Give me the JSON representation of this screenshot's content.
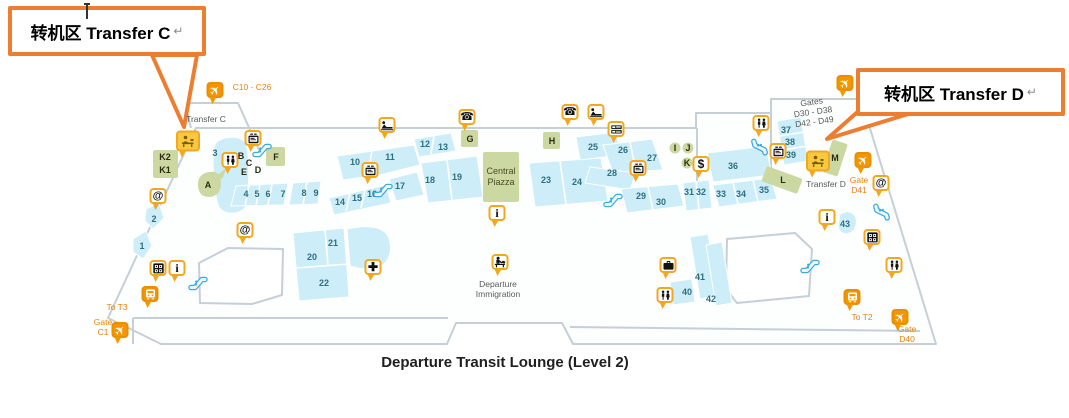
{
  "title": "Departure Transit Lounge (Level 2)",
  "callouts": [
    {
      "label": "转机区 Transfer C",
      "mark": "↵"
    },
    {
      "label": "转机区 Transfer D",
      "mark": "↵"
    }
  ],
  "colors": {
    "callout_orange": "#ED7D31",
    "pin_border_amber": "#F2A71E",
    "pin_orange": "#F49600",
    "retail_blue": "#CDEEF8",
    "zone_green": "#CBD8A2",
    "wall_gray": "#C5CFD7",
    "number_teal": "#2F6F80",
    "gate_text_orange": "#E8820C",
    "escalator_blue": "#3FA9DC"
  },
  "map": {
    "numbers": [
      {
        "n": "1",
        "x": 142,
        "y": 246
      },
      {
        "n": "2",
        "x": 154,
        "y": 219
      },
      {
        "n": "3",
        "x": 215,
        "y": 153
      },
      {
        "n": "4",
        "x": 246,
        "y": 194
      },
      {
        "n": "5",
        "x": 257,
        "y": 194
      },
      {
        "n": "6",
        "x": 268,
        "y": 194
      },
      {
        "n": "7",
        "x": 283,
        "y": 194
      },
      {
        "n": "8",
        "x": 304,
        "y": 193
      },
      {
        "n": "9",
        "x": 316,
        "y": 193
      },
      {
        "n": "10",
        "x": 355,
        "y": 162
      },
      {
        "n": "11",
        "x": 390,
        "y": 157
      },
      {
        "n": "12",
        "x": 425,
        "y": 144
      },
      {
        "n": "13",
        "x": 443,
        "y": 147
      },
      {
        "n": "14",
        "x": 340,
        "y": 202
      },
      {
        "n": "15",
        "x": 357,
        "y": 198
      },
      {
        "n": "16",
        "x": 372,
        "y": 194
      },
      {
        "n": "17",
        "x": 400,
        "y": 186
      },
      {
        "n": "18",
        "x": 430,
        "y": 180
      },
      {
        "n": "19",
        "x": 457,
        "y": 177
      },
      {
        "n": "20",
        "x": 312,
        "y": 257
      },
      {
        "n": "21",
        "x": 333,
        "y": 243
      },
      {
        "n": "22",
        "x": 324,
        "y": 283
      },
      {
        "n": "23",
        "x": 546,
        "y": 180
      },
      {
        "n": "24",
        "x": 577,
        "y": 182
      },
      {
        "n": "25",
        "x": 593,
        "y": 147
      },
      {
        "n": "26",
        "x": 623,
        "y": 150
      },
      {
        "n": "27",
        "x": 652,
        "y": 158
      },
      {
        "n": "28",
        "x": 612,
        "y": 173
      },
      {
        "n": "29",
        "x": 641,
        "y": 196
      },
      {
        "n": "30",
        "x": 661,
        "y": 202
      },
      {
        "n": "31",
        "x": 689,
        "y": 192
      },
      {
        "n": "32",
        "x": 701,
        "y": 192
      },
      {
        "n": "33",
        "x": 721,
        "y": 194
      },
      {
        "n": "34",
        "x": 741,
        "y": 194
      },
      {
        "n": "35",
        "x": 764,
        "y": 190
      },
      {
        "n": "36",
        "x": 733,
        "y": 166
      },
      {
        "n": "37",
        "x": 786,
        "y": 130
      },
      {
        "n": "38",
        "x": 790,
        "y": 142
      },
      {
        "n": "39",
        "x": 791,
        "y": 155
      },
      {
        "n": "40",
        "x": 687,
        "y": 292
      },
      {
        "n": "41",
        "x": 700,
        "y": 277
      },
      {
        "n": "42",
        "x": 711,
        "y": 299
      },
      {
        "n": "43",
        "x": 845,
        "y": 224
      }
    ],
    "letters": [
      {
        "t": "A",
        "x": 208,
        "y": 185
      },
      {
        "t": "B",
        "x": 241,
        "y": 156
      },
      {
        "t": "C",
        "x": 249,
        "y": 163
      },
      {
        "t": "D",
        "x": 258,
        "y": 170
      },
      {
        "t": "E",
        "x": 244,
        "y": 172
      },
      {
        "t": "F",
        "x": 276,
        "y": 157
      },
      {
        "t": "G",
        "x": 470,
        "y": 139
      },
      {
        "t": "H",
        "x": 552,
        "y": 141
      },
      {
        "t": "I",
        "x": 675,
        "y": 148
      },
      {
        "t": "J",
        "x": 688,
        "y": 148
      },
      {
        "t": "K",
        "x": 687,
        "y": 163
      },
      {
        "t": "L",
        "x": 783,
        "y": 180
      },
      {
        "t": "M",
        "x": 835,
        "y": 158
      },
      {
        "t": "K2",
        "x": 165,
        "y": 157
      },
      {
        "t": "K1",
        "x": 165,
        "y": 170
      }
    ],
    "labels": [
      {
        "text": "C10 - C26",
        "x": 252,
        "y": 87,
        "cls": "gate"
      },
      {
        "text": "Transfer C",
        "x": 206,
        "y": 119,
        "cls": "gray"
      },
      {
        "text": "To T3",
        "x": 117,
        "y": 307,
        "cls": "gate"
      },
      {
        "text": "Gate\nC1",
        "x": 103,
        "y": 327,
        "cls": "gate"
      },
      {
        "text": "Central\nPiazza",
        "x": 501,
        "y": 177,
        "cls": "green"
      },
      {
        "text": "Departure\nImmigration",
        "x": 498,
        "y": 289,
        "cls": "gray"
      },
      {
        "text": "Gates\nD30 - D38\nD42 - D49",
        "x": 813,
        "y": 112,
        "cls": "gray",
        "r": -8
      },
      {
        "text": "Transfer D",
        "x": 826,
        "y": 184,
        "cls": "gray"
      },
      {
        "text": "Gate\nD41",
        "x": 859,
        "y": 185,
        "cls": "gate"
      },
      {
        "text": "To T2",
        "x": 862,
        "y": 317,
        "cls": "gate"
      },
      {
        "text": "Gate\nD40",
        "x": 907,
        "y": 334,
        "cls": "gate"
      }
    ],
    "pins": [
      {
        "type": "plane",
        "variant": "orange",
        "x": 215,
        "y": 90
      },
      {
        "type": "plane",
        "variant": "orange",
        "x": 845,
        "y": 83
      },
      {
        "type": "plane",
        "variant": "orange",
        "x": 863,
        "y": 160
      },
      {
        "type": "plane",
        "variant": "orange",
        "x": 120,
        "y": 330
      },
      {
        "type": "plane",
        "variant": "orange",
        "x": 900,
        "y": 317
      },
      {
        "type": "train",
        "variant": "orange",
        "x": 150,
        "y": 294
      },
      {
        "type": "train",
        "variant": "orange",
        "x": 852,
        "y": 297
      },
      {
        "type": "counter",
        "variant": "counter",
        "x": 188,
        "y": 141
      },
      {
        "type": "counter",
        "variant": "counter",
        "x": 818,
        "y": 161
      },
      {
        "type": "at",
        "x": 158,
        "y": 196
      },
      {
        "type": "at",
        "x": 245,
        "y": 230
      },
      {
        "type": "at",
        "x": 881,
        "y": 183
      },
      {
        "type": "info",
        "x": 177,
        "y": 268
      },
      {
        "type": "info",
        "x": 497,
        "y": 213
      },
      {
        "type": "info",
        "x": 827,
        "y": 217
      },
      {
        "type": "dollar",
        "x": 701,
        "y": 164
      },
      {
        "type": "phone",
        "x": 467,
        "y": 117
      },
      {
        "type": "phone",
        "x": 570,
        "y": 112
      },
      {
        "type": "recliner",
        "x": 387,
        "y": 125
      },
      {
        "type": "recliner",
        "x": 596,
        "y": 112
      },
      {
        "type": "tv",
        "x": 253,
        "y": 138
      },
      {
        "type": "tv",
        "x": 370,
        "y": 170
      },
      {
        "type": "tv",
        "x": 638,
        "y": 168
      },
      {
        "type": "tv",
        "x": 778,
        "y": 151
      },
      {
        "type": "bills",
        "x": 616,
        "y": 129
      },
      {
        "type": "restroom",
        "x": 230,
        "y": 160
      },
      {
        "type": "restroom",
        "x": 761,
        "y": 123
      },
      {
        "type": "restroom",
        "x": 665,
        "y": 295
      },
      {
        "type": "restroom",
        "x": 894,
        "y": 265
      },
      {
        "type": "games",
        "x": 158,
        "y": 268
      },
      {
        "type": "games",
        "x": 872,
        "y": 237
      },
      {
        "type": "medical",
        "x": 373,
        "y": 267
      },
      {
        "type": "briefcase",
        "x": 668,
        "y": 265
      },
      {
        "type": "immigration",
        "x": 500,
        "y": 262
      },
      {
        "type": "escalator",
        "x": 262,
        "y": 150
      },
      {
        "type": "escalator",
        "x": 383,
        "y": 190
      },
      {
        "type": "escalator",
        "x": 198,
        "y": 283
      },
      {
        "type": "escalator",
        "x": 613,
        "y": 200
      },
      {
        "type": "escalator",
        "x": 760,
        "y": 147,
        "r": 75
      },
      {
        "type": "escalator",
        "x": 810,
        "y": 266
      },
      {
        "type": "escalator",
        "x": 882,
        "y": 212,
        "r": 75
      }
    ]
  }
}
